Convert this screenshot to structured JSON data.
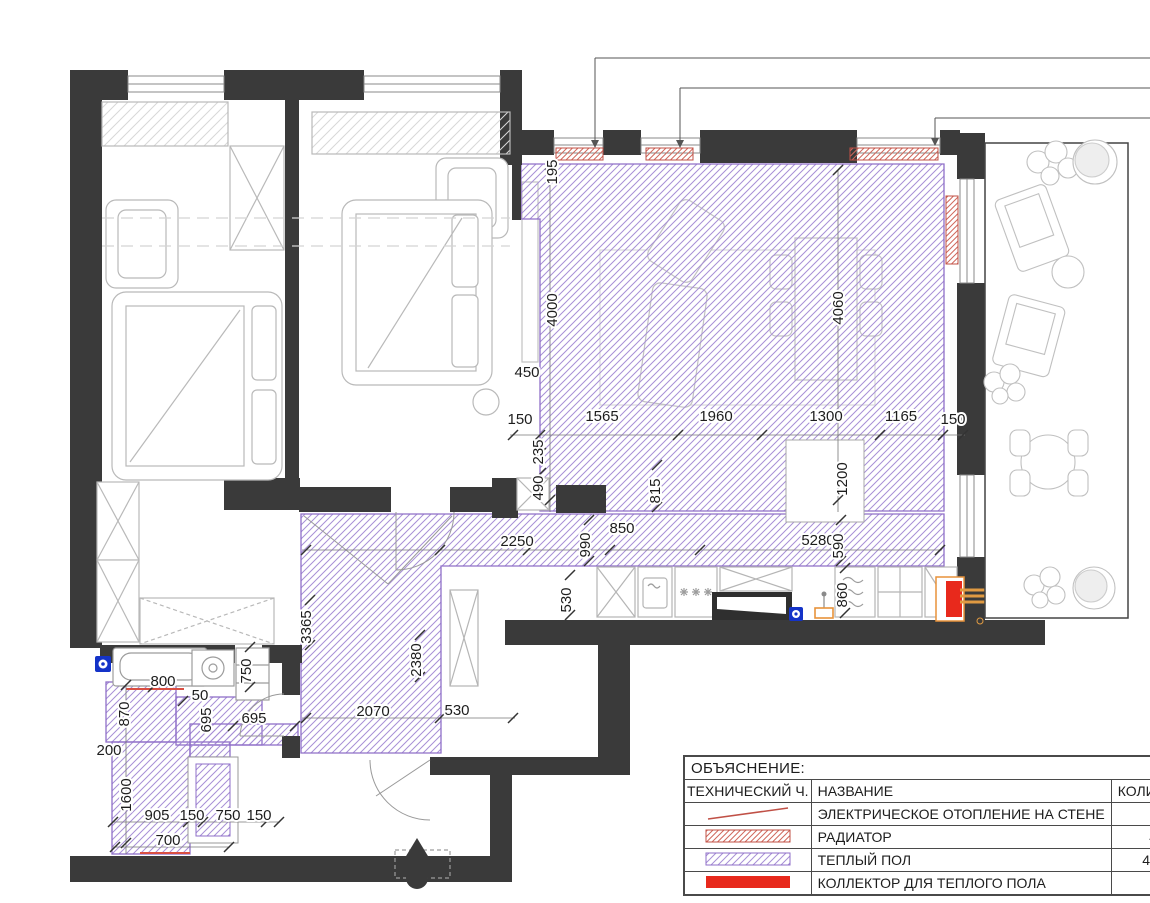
{
  "drawing": {
    "type": "apartment heating floor plan",
    "colors": {
      "wall": "#3a3a3a",
      "warm_floor": "#8f6fc8",
      "warm_floor_hatch": "#a78fd6",
      "radiator_hatch": "#d0685c",
      "collector_red": "#e8291c",
      "pipe_orange": "#e09a42",
      "valve_blue": "#1433c8",
      "furniture_gray": "#b9b9b9"
    }
  },
  "dimensions": [
    {
      "v": "195",
      "x": 557,
      "y": 172,
      "r": -90
    },
    {
      "v": "4000",
      "x": 557,
      "y": 310,
      "r": -90
    },
    {
      "v": "4060",
      "x": 843,
      "y": 308,
      "r": -90
    },
    {
      "v": "450",
      "x": 527,
      "y": 377,
      "r": 0
    },
    {
      "v": "150",
      "x": 520,
      "y": 424,
      "r": 0
    },
    {
      "v": "1565",
      "x": 602,
      "y": 421,
      "r": 0
    },
    {
      "v": "1960",
      "x": 716,
      "y": 421,
      "r": 0
    },
    {
      "v": "1300",
      "x": 826,
      "y": 421,
      "r": 0
    },
    {
      "v": "1165",
      "x": 901,
      "y": 421,
      "r": 0
    },
    {
      "v": "150",
      "x": 953,
      "y": 424,
      "r": 0
    },
    {
      "v": "235",
      "x": 543,
      "y": 452,
      "r": -90
    },
    {
      "v": "490",
      "x": 543,
      "y": 488,
      "r": -90
    },
    {
      "v": "815",
      "x": 660,
      "y": 491,
      "r": -90
    },
    {
      "v": "1200",
      "x": 847,
      "y": 479,
      "r": -90
    },
    {
      "v": "850",
      "x": 622,
      "y": 533,
      "r": 0
    },
    {
      "v": "990",
      "x": 590,
      "y": 545,
      "r": -90
    },
    {
      "v": "2250",
      "x": 517,
      "y": 546,
      "r": 0
    },
    {
      "v": "5280",
      "x": 818,
      "y": 545,
      "r": 0
    },
    {
      "v": "590",
      "x": 843,
      "y": 546,
      "r": -90
    },
    {
      "v": "530",
      "x": 571,
      "y": 600,
      "r": -90
    },
    {
      "v": "860",
      "x": 847,
      "y": 595,
      "r": -90
    },
    {
      "v": "3365",
      "x": 311,
      "y": 627,
      "r": -90
    },
    {
      "v": "2380",
      "x": 421,
      "y": 660,
      "r": -90
    },
    {
      "v": "750",
      "x": 251,
      "y": 671,
      "r": -90
    },
    {
      "v": "800",
      "x": 163,
      "y": 686,
      "r": 0
    },
    {
      "v": "50",
      "x": 200,
      "y": 700,
      "r": 0
    },
    {
      "v": "870",
      "x": 129,
      "y": 714,
      "r": -90
    },
    {
      "v": "695",
      "x": 211,
      "y": 720,
      "r": -90
    },
    {
      "v": "695",
      "x": 254,
      "y": 723,
      "r": 0
    },
    {
      "v": "2070",
      "x": 373,
      "y": 716,
      "r": 0
    },
    {
      "v": "530",
      "x": 457,
      "y": 715,
      "r": 0
    },
    {
      "v": "200",
      "x": 109,
      "y": 755,
      "r": 0
    },
    {
      "v": "1600",
      "x": 131,
      "y": 795,
      "r": -90
    },
    {
      "v": "905",
      "x": 157,
      "y": 820,
      "r": 0
    },
    {
      "v": "150",
      "x": 192,
      "y": 820,
      "r": 0
    },
    {
      "v": "750",
      "x": 228,
      "y": 820,
      "r": 0
    },
    {
      "v": "150",
      "x": 259,
      "y": 820,
      "r": 0
    },
    {
      "v": "700",
      "x": 168,
      "y": 845,
      "r": 0
    }
  ],
  "legend": {
    "title": "ОБЪЯСНЕНИЕ:",
    "columns": [
      "ТЕХНИЧЕСКИЙ Ч.",
      "НАЗВАНИЕ",
      "КОЛИЧЕСТВО"
    ],
    "rows": [
      {
        "symbol": "electric-heating-line",
        "name": "ЭЛЕКТРИЧЕСКОЕ ОТОПЛЕНИЕ НА СТЕНЕ",
        "qty": "3 м²"
      },
      {
        "symbol": "radiator-hatch",
        "name": "РАДИАТОР",
        "qty": "4 шт."
      },
      {
        "symbol": "warm-floor-hatch",
        "name": "ТЕПЛЫЙ ПОЛ",
        "qty": "44,9 м²"
      },
      {
        "symbol": "collector-solid",
        "name": "КОЛЛЕКТОР ДЛЯ ТЕПЛОГО ПОЛА",
        "qty": "1 шт."
      }
    ]
  }
}
